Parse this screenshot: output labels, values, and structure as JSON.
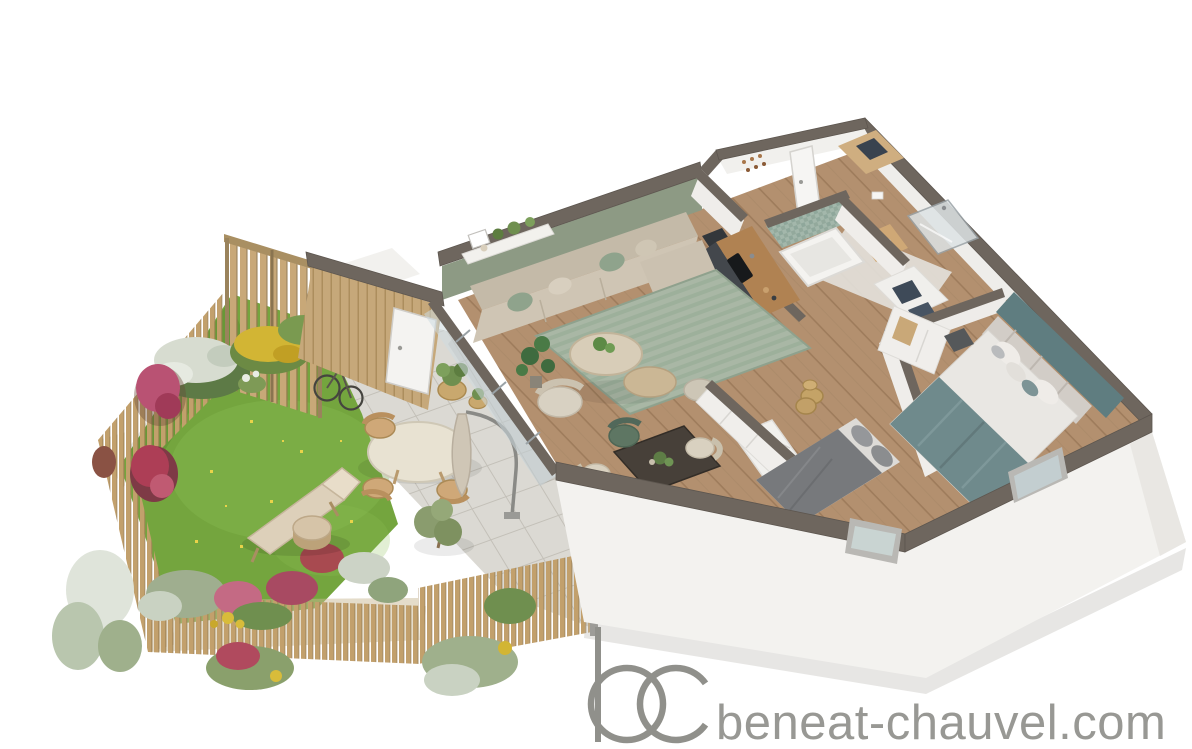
{
  "watermark": {
    "logo_initials": "bc",
    "site_text": "beneat-chauvel.com",
    "color": "#90908b"
  },
  "palette": {
    "background": "#ffffff",
    "wall_cap": "#6e665e",
    "exterior_wall_white": "#f3f2ef",
    "interior_floor_wood": "#b3906f",
    "accent_wall_sage": "#8d9a84",
    "accent_wall_teal": "#5f7d80",
    "lawn_green": "#74a53e",
    "fence_wood": "#c2a06c",
    "paver_stone": "#dbd9d3",
    "rug_sage": "#a9b7a5",
    "sofa_beige": "#cfc5b4",
    "kitchen_charcoal": "#43474c",
    "bathroom_mosaic": "#a3b7ab",
    "bed_teal_blanket": "#6f8a8c",
    "bed_gray_duvet": "#77797c",
    "dining_table_wood": "#474039"
  },
  "scene": {
    "description": "3D axonometric floor-plan rendering of a two-bedroom apartment with private garden and terrace",
    "garden": {
      "elements": [
        "lawn",
        "wooden-slat-fence",
        "flower-beds",
        "deck-chair",
        "tree-stump-table",
        "bicycle",
        "olive-shrub",
        "wicker-planters"
      ]
    },
    "terrace": {
      "elements": [
        "stone-pavers",
        "round-outdoor-table",
        "wooden-chairs",
        "closed-parasol"
      ]
    },
    "apartment": {
      "rooms": [
        {
          "name": "living-room",
          "furniture": [
            "corner-sofa",
            "sage-striped-rug",
            "round-coffee-tables",
            "armchair",
            "console-shelf",
            "monstera-plant",
            "pouf"
          ]
        },
        {
          "name": "dining-area",
          "furniture": [
            "dark-wood-table",
            "upholstered-chairs",
            "green-chair",
            "centerpiece-plant"
          ]
        },
        {
          "name": "kitchen",
          "furniture": [
            "charcoal-cabinets",
            "wood-countertop",
            "black-sink"
          ]
        },
        {
          "name": "entry-hall",
          "furniture": [
            "front-door",
            "coat-hooks"
          ]
        },
        {
          "name": "bathroom",
          "furniture": [
            "bathtub",
            "mosaic-tile-wall",
            "wood-vanity"
          ]
        },
        {
          "name": "shower-room",
          "furniture": [
            "glass-shower"
          ]
        },
        {
          "name": "utility-closet",
          "furniture": [
            "stacked-appliances"
          ]
        },
        {
          "name": "small-bedroom",
          "furniture": [
            "gray-double-bed",
            "white-wardrobe",
            "wicker-basket",
            "bookshelf"
          ]
        },
        {
          "name": "master-bedroom",
          "furniture": [
            "double-bed-teal-blanket",
            "padded-headboard",
            "teal-accent-wall",
            "wardrobe",
            "dark-nightstand"
          ]
        },
        {
          "name": "storage-room",
          "furniture": [
            "shelving",
            "garden-door"
          ]
        }
      ]
    }
  }
}
